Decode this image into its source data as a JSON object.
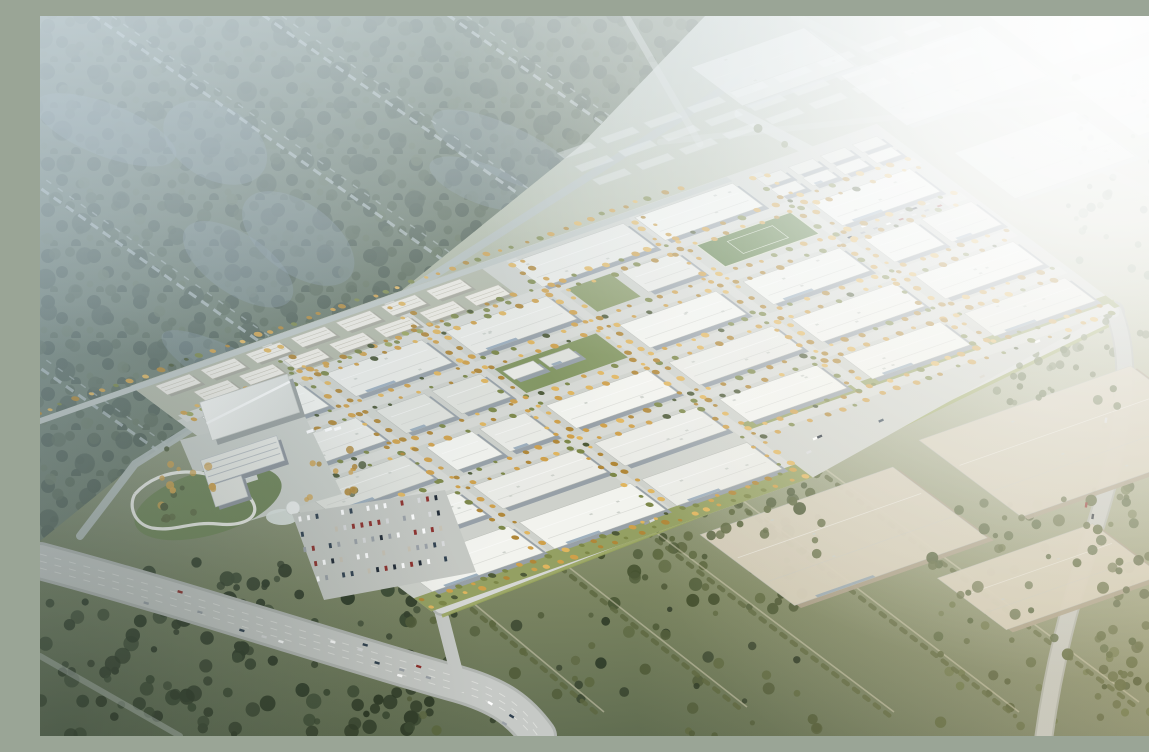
{
  "scene": {
    "label": "Aerial rendering of a master-planned logistics / industrial park with white warehouse rows, a residential strip, hotel campus with pool, parking lots, highways, surrounding forest and farmland, and hazy distant warehouses lit from the upper right",
    "areas": [
      "northwest-forest",
      "residential-strip",
      "industrial-park-grid",
      "hotel-campus",
      "exhibition-hall",
      "visitor-parking",
      "highway-interchange",
      "front-avenue",
      "distant-warehouses",
      "southern-fields",
      "northeast-sun-haze"
    ]
  },
  "palette": {
    "forest_base": "#5e6c55",
    "forest_dark": "#3e4c3a",
    "forest_mid": "#49573f",
    "forest_light": "#5a684c",
    "tree_dark": "#333f2b",
    "tree_olive": "#5c6740",
    "road": "#c6c9c6",
    "road_light": "#d6d8d5",
    "road_casing": "#b2b6b2",
    "road_faint": "#cfd4d2",
    "lane": "#e3e5e1",
    "park_slab": "#ced1cb",
    "park_street": "#d7d9d4",
    "roof_white": "#eaebe6",
    "roof_bright": "#f2f3ee",
    "roof_shade": "#e0e2dc",
    "wall_shadow": "#97a0a7",
    "residential_roof": "#efece3",
    "residential_wall": "#a7a79a",
    "distant_beige_roof": "#d5cebc",
    "distant_beige_wall": "#a99e89",
    "distant_white_roof": "#eef1f2",
    "distant_white_wall": "#ccd3d7",
    "gold_tree": "#cfa04a",
    "gold_tree_dark": "#b08738",
    "gold_tree_light": "#e0b55e",
    "green_street_tree": "#7c8748",
    "lawn": "#7b8f55",
    "sports_field": "#5d7d46",
    "front_strip": "#8e9a58",
    "verge_green": "#9aa75d",
    "pool_blue": "#62b9d6",
    "plaza": "#cbcfc9",
    "path_white": "#f1f1ec",
    "office_accent": "#8fa3b5",
    "haze": "#e9f1f4",
    "glow_white": "#ffffff",
    "warm_light": "#d8bc7a",
    "cool_tint": "#9db3c6",
    "vignette": "#1c2616",
    "car_colors": [
      "#ffffff",
      "#d9dadb",
      "#9aa0a6",
      "#30404f",
      "#8d2f2b",
      "#1f2833",
      "#c8c2b4"
    ]
  }
}
